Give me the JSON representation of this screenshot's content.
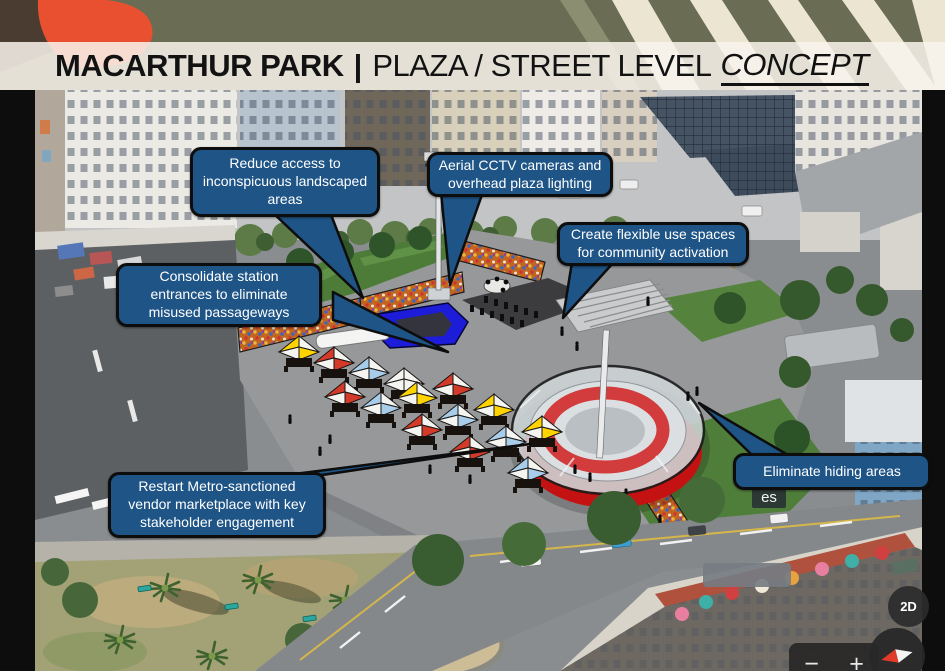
{
  "slide": {
    "title": {
      "park": "MACARTHUR PARK",
      "separator": "|",
      "section": "PLAZA / STREET LEVEL",
      "emphasis": "CONCEPT"
    }
  },
  "callouts": [
    {
      "id": "reduce-access",
      "text": "Reduce access to inconspicuous landscaped areas"
    },
    {
      "id": "cctv-lighting",
      "text": "Aerial CCTV cameras and overhead plaza lighting"
    },
    {
      "id": "flexible-spaces",
      "text": "Create flexible use spaces for community activation"
    },
    {
      "id": "consolidate-entrances",
      "text": "Consolidate station entrances to eliminate misused passageways"
    },
    {
      "id": "vendor-marketplace",
      "text": "Restart Metro-sanctioned vendor marketplace with key stakeholder engagement"
    },
    {
      "id": "eliminate-hiding",
      "text": "Eliminate hiding areas"
    }
  ],
  "map": {
    "partial_place_label": "es",
    "controls": {
      "mode_toggle": "2D",
      "zoom_out": "−",
      "zoom_in": "+",
      "compass": "compass-icon"
    }
  },
  "colors": {
    "callout_bg": "#1e5486",
    "callout_border": "#0d0d0d",
    "lawn_green": "#4e7d39",
    "skylight_blue": "#1c1cd9",
    "amphitheater_red": "#c41212",
    "mosaic_orange": "#c2651f",
    "tent_yellow": "#ffd400",
    "tent_red": "#d43a2a",
    "tent_light_blue": "#a8cdeb"
  }
}
